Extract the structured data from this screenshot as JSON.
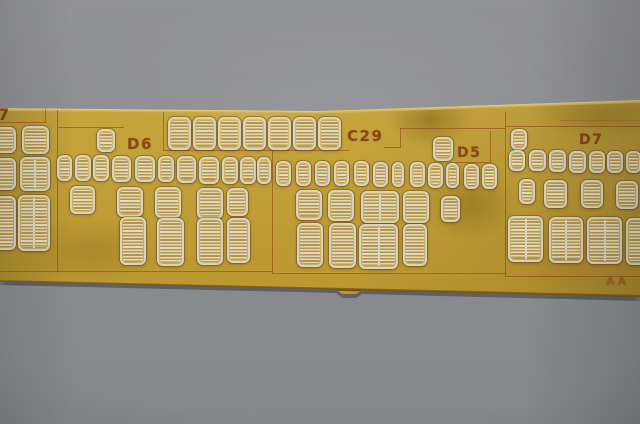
{
  "scene": {
    "description": "Close-up photograph of a brass photo-etched model detail fret lying on gray paper. The fret holds rows of small louvered vent parts inside etched panels labeled 7, D6, C29, D5 and D7, with a faint maker mark near the lower right edge.",
    "colors": {
      "paper": "#8c8d91",
      "brass": "#c2a13c",
      "etch_line": "#913e10",
      "etch_text": "#7d3a10",
      "part_rim": "#d9d3c3",
      "part_louvre_dark": "#b3954f",
      "part_louvre_light": "#e3dabd"
    }
  },
  "fret": {
    "labels": [
      {
        "text": "7",
        "x": -2,
        "y": 107,
        "size": 16
      },
      {
        "text": "D6",
        "x": 127,
        "y": 137,
        "size": 15
      },
      {
        "text": "C29",
        "x": 347,
        "y": 129,
        "size": 15
      },
      {
        "text": "D5",
        "x": 457,
        "y": 146,
        "size": 14
      },
      {
        "text": "D7",
        "x": 579,
        "y": 133,
        "size": 14
      },
      {
        "text": "AA",
        "x": 606,
        "y": 276,
        "size": 11,
        "maker": true
      }
    ],
    "lines": [
      {
        "x": 0,
        "y": 122,
        "w": 46,
        "h": 1
      },
      {
        "x": 45,
        "y": 109,
        "w": 1,
        "h": 14
      },
      {
        "x": 57,
        "y": 110,
        "w": 1,
        "h": 162
      },
      {
        "x": 58,
        "y": 127,
        "w": 66,
        "h": 1
      },
      {
        "x": 163,
        "y": 112,
        "w": 1,
        "h": 39
      },
      {
        "x": 163,
        "y": 150,
        "w": 186,
        "h": 1
      },
      {
        "x": 384,
        "y": 147,
        "w": 17,
        "h": 1
      },
      {
        "x": 400,
        "y": 128,
        "w": 1,
        "h": 20
      },
      {
        "x": 400,
        "y": 128,
        "w": 106,
        "h": 1
      },
      {
        "x": 272,
        "y": 151,
        "w": 1,
        "h": 122
      },
      {
        "x": 455,
        "y": 162,
        "w": 36,
        "h": 1
      },
      {
        "x": 490,
        "y": 131,
        "w": 1,
        "h": 32
      },
      {
        "x": 505,
        "y": 112,
        "w": 1,
        "h": 165
      },
      {
        "x": 505,
        "y": 126,
        "w": 135,
        "h": 1
      },
      {
        "x": 560,
        "y": 120,
        "w": 80,
        "h": 1,
        "faint": true
      },
      {
        "x": 0,
        "y": 271,
        "w": 273,
        "h": 1
      },
      {
        "x": 272,
        "y": 273,
        "w": 234,
        "h": 1
      },
      {
        "x": 505,
        "y": 276,
        "w": 136,
        "h": 1
      }
    ],
    "vents": [
      {
        "x": -8,
        "y": 127,
        "w": 24,
        "h": 26
      },
      {
        "x": 22,
        "y": 126,
        "w": 27,
        "h": 28
      },
      {
        "x": -10,
        "y": 158,
        "w": 26,
        "h": 32
      },
      {
        "x": 20,
        "y": 157,
        "w": 30,
        "h": 34
      },
      {
        "x": -12,
        "y": 196,
        "w": 28,
        "h": 54
      },
      {
        "x": 18,
        "y": 195,
        "w": 32,
        "h": 56
      },
      {
        "x": 97,
        "y": 129,
        "w": 18,
        "h": 23
      },
      {
        "x": 57,
        "y": 155,
        "w": 15,
        "h": 26
      },
      {
        "x": 75,
        "y": 155,
        "w": 16,
        "h": 26
      },
      {
        "x": 93,
        "y": 155,
        "w": 16,
        "h": 26
      },
      {
        "x": 112,
        "y": 156,
        "w": 19,
        "h": 26
      },
      {
        "x": 135,
        "y": 156,
        "w": 20,
        "h": 26
      },
      {
        "x": 158,
        "y": 156,
        "w": 16,
        "h": 26
      },
      {
        "x": 177,
        "y": 156,
        "w": 19,
        "h": 27
      },
      {
        "x": 199,
        "y": 157,
        "w": 20,
        "h": 27
      },
      {
        "x": 222,
        "y": 157,
        "w": 16,
        "h": 27
      },
      {
        "x": 240,
        "y": 157,
        "w": 16,
        "h": 27
      },
      {
        "x": 257,
        "y": 157,
        "w": 14,
        "h": 27
      },
      {
        "x": 70,
        "y": 186,
        "w": 25,
        "h": 28
      },
      {
        "x": 117,
        "y": 187,
        "w": 26,
        "h": 30
      },
      {
        "x": 155,
        "y": 187,
        "w": 26,
        "h": 31
      },
      {
        "x": 197,
        "y": 188,
        "w": 26,
        "h": 31
      },
      {
        "x": 227,
        "y": 188,
        "w": 21,
        "h": 28
      },
      {
        "x": 120,
        "y": 217,
        "w": 26,
        "h": 48
      },
      {
        "x": 157,
        "y": 218,
        "w": 27,
        "h": 48
      },
      {
        "x": 197,
        "y": 218,
        "w": 26,
        "h": 47
      },
      {
        "x": 227,
        "y": 218,
        "w": 23,
        "h": 45
      },
      {
        "x": 168,
        "y": 117,
        "w": 23,
        "h": 33
      },
      {
        "x": 193,
        "y": 117,
        "w": 23,
        "h": 33
      },
      {
        "x": 218,
        "y": 117,
        "w": 23,
        "h": 33
      },
      {
        "x": 243,
        "y": 117,
        "w": 23,
        "h": 33
      },
      {
        "x": 268,
        "y": 117,
        "w": 23,
        "h": 33
      },
      {
        "x": 293,
        "y": 117,
        "w": 23,
        "h": 33
      },
      {
        "x": 318,
        "y": 117,
        "w": 23,
        "h": 33
      },
      {
        "x": 433,
        "y": 137,
        "w": 20,
        "h": 24
      },
      {
        "x": 511,
        "y": 129,
        "w": 16,
        "h": 21
      },
      {
        "x": 276,
        "y": 161,
        "w": 15,
        "h": 25
      },
      {
        "x": 296,
        "y": 161,
        "w": 15,
        "h": 25
      },
      {
        "x": 315,
        "y": 161,
        "w": 15,
        "h": 25
      },
      {
        "x": 334,
        "y": 161,
        "w": 15,
        "h": 25
      },
      {
        "x": 354,
        "y": 161,
        "w": 15,
        "h": 25
      },
      {
        "x": 373,
        "y": 162,
        "w": 15,
        "h": 25
      },
      {
        "x": 392,
        "y": 162,
        "w": 12,
        "h": 25
      },
      {
        "x": 410,
        "y": 162,
        "w": 15,
        "h": 25
      },
      {
        "x": 428,
        "y": 163,
        "w": 15,
        "h": 25
      },
      {
        "x": 446,
        "y": 163,
        "w": 13,
        "h": 25
      },
      {
        "x": 464,
        "y": 164,
        "w": 15,
        "h": 25
      },
      {
        "x": 482,
        "y": 164,
        "w": 15,
        "h": 25
      },
      {
        "x": 296,
        "y": 190,
        "w": 26,
        "h": 30
      },
      {
        "x": 328,
        "y": 190,
        "w": 26,
        "h": 31
      },
      {
        "x": 361,
        "y": 191,
        "w": 38,
        "h": 32
      },
      {
        "x": 403,
        "y": 191,
        "w": 26,
        "h": 32
      },
      {
        "x": 441,
        "y": 196,
        "w": 19,
        "h": 26
      },
      {
        "x": 297,
        "y": 223,
        "w": 26,
        "h": 44
      },
      {
        "x": 329,
        "y": 223,
        "w": 27,
        "h": 45
      },
      {
        "x": 359,
        "y": 224,
        "w": 39,
        "h": 45
      },
      {
        "x": 403,
        "y": 224,
        "w": 24,
        "h": 42
      },
      {
        "x": 509,
        "y": 150,
        "w": 16,
        "h": 21
      },
      {
        "x": 529,
        "y": 150,
        "w": 17,
        "h": 21
      },
      {
        "x": 549,
        "y": 150,
        "w": 17,
        "h": 22
      },
      {
        "x": 569,
        "y": 151,
        "w": 17,
        "h": 22
      },
      {
        "x": 589,
        "y": 151,
        "w": 16,
        "h": 22
      },
      {
        "x": 607,
        "y": 151,
        "w": 16,
        "h": 22
      },
      {
        "x": 626,
        "y": 151,
        "w": 15,
        "h": 22
      },
      {
        "x": 519,
        "y": 179,
        "w": 16,
        "h": 25
      },
      {
        "x": 544,
        "y": 180,
        "w": 23,
        "h": 28
      },
      {
        "x": 581,
        "y": 180,
        "w": 22,
        "h": 28
      },
      {
        "x": 616,
        "y": 181,
        "w": 22,
        "h": 28
      },
      {
        "x": 508,
        "y": 216,
        "w": 35,
        "h": 46
      },
      {
        "x": 549,
        "y": 217,
        "w": 34,
        "h": 46
      },
      {
        "x": 587,
        "y": 217,
        "w": 35,
        "h": 47
      },
      {
        "x": 626,
        "y": 218,
        "w": 20,
        "h": 47
      }
    ]
  }
}
